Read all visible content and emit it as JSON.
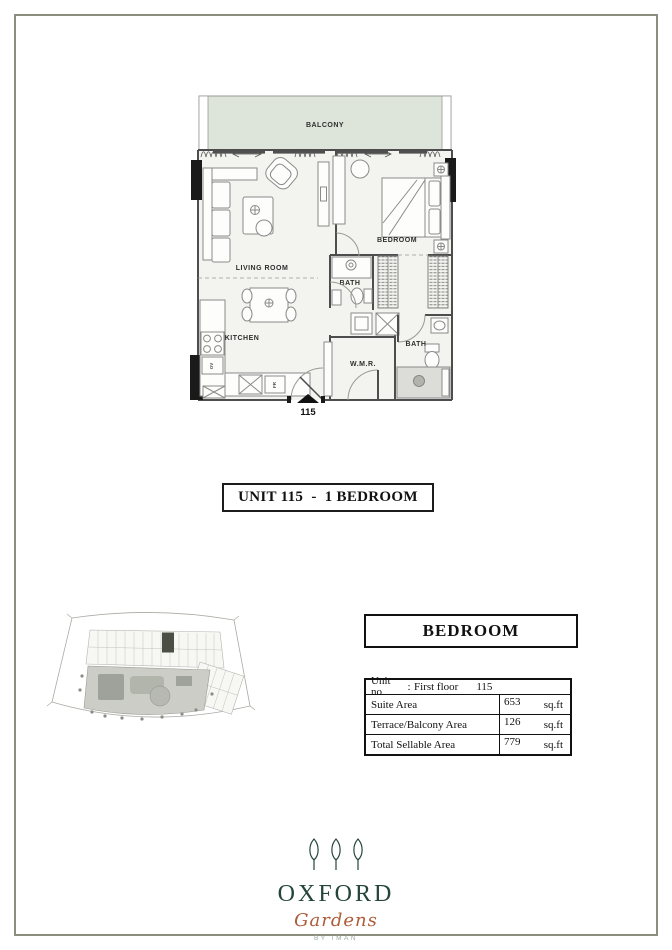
{
  "floor_plan": {
    "balcony": "BALCONY",
    "living_room": "LIVING ROOM",
    "kitchen": "KITCHEN",
    "bath_1": "BATH",
    "wmr": "W.M.R.",
    "bath_2": "BATH",
    "bedroom": "BEDROOM",
    "unit_number": "115",
    "fridge": "FR",
    "oven": "OV"
  },
  "title": "UNIT 115  -  1 BEDROOM",
  "details": {
    "header": "BEDROOM",
    "unit_row": {
      "label": "Unit no",
      "colon": ":",
      "floor": "First floor",
      "number": "115"
    },
    "rows": [
      {
        "label": "Suite Area",
        "value": "653",
        "unit": "sq.ft"
      },
      {
        "label": "Terrace/Balcony Area",
        "value": "126",
        "unit": "sq.ft"
      },
      {
        "label": "Total Sellable Area",
        "value": "779",
        "unit": "sq.ft"
      }
    ]
  },
  "logo": {
    "name": "OXFORD",
    "script": "Gardens",
    "byline": "BY IMAN"
  },
  "colors": {
    "frame_border": "#8b8e7e",
    "balcony_fill": "#dde4d9",
    "plan_interior": "#f3f3ef",
    "keyplan_highlight": "#4a4e44",
    "logo_green": "#24453a",
    "logo_copper": "#ad5c38"
  }
}
